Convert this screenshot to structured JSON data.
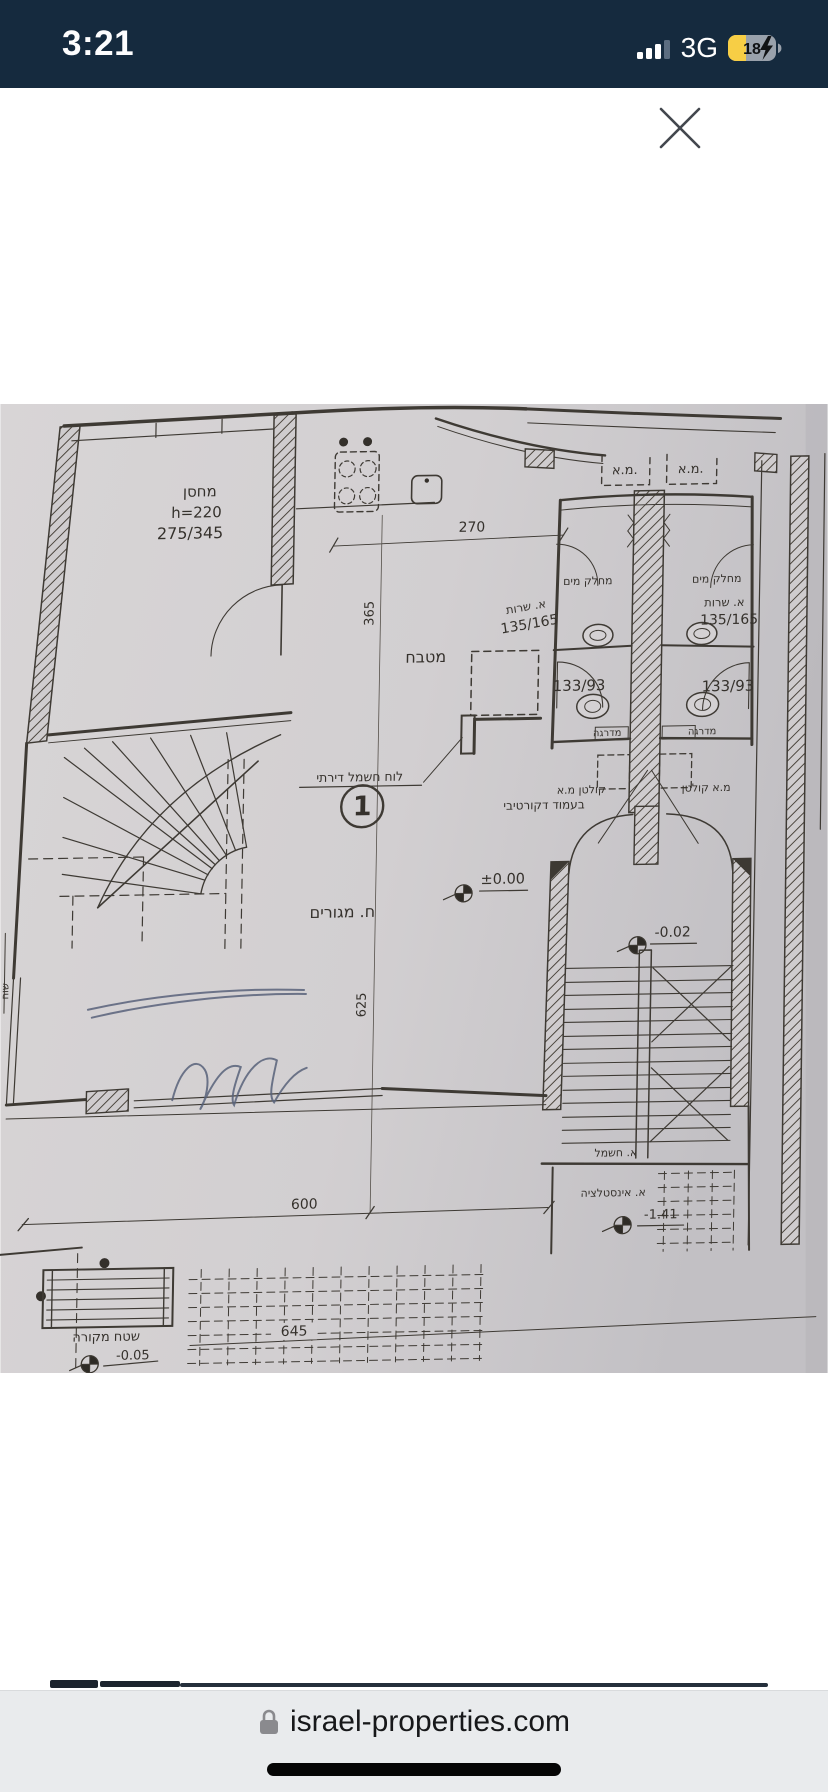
{
  "status_bar": {
    "time": "3:21",
    "network": "3G",
    "battery_level": "18"
  },
  "icons": {
    "close": "x-icon",
    "cellular": "signal-bars-icon",
    "battery": "battery-charging-icon",
    "lock": "padlock-icon"
  },
  "floor_plan": {
    "labels": {
      "storage": "מחסן",
      "storage_height": "h=220",
      "storage_dims": "275/345",
      "kitchen": "מטבח",
      "dim_kitchen_width": "270",
      "dim_kitchen_depth": "365",
      "electrical_panel_note": "לוח חשמל דירתי",
      "plan_number": "1",
      "ac_unit_left": "מ.א.",
      "ac_unit_right": "מ.א.",
      "water_divider_left": "מחלק מים",
      "water_divider_right": "מחלק מים",
      "service_room_left": "א. שרות",
      "service_room_left_dims": "135/165",
      "service_room_right": "א. שרות",
      "service_room_right_dims": "135/165",
      "bathroom_left_dims": "133/93",
      "bathroom_right_dims": "133/93",
      "step_left": "מדרגה",
      "step_right": "מדרגה",
      "drain_left": "קולטן מ.א",
      "drain_right": "מ.א קולטן",
      "decorative_column_note": "בעמוד דקורטיבי",
      "living_room": "ח. מגורים",
      "dim_living_depth": "625",
      "level_main": "±0.00",
      "level_stairwell": "-0.02",
      "electrical_closet": "א. חשמל",
      "plumbing_closet": "א. אינסטלציה",
      "level_entry": "-1.41",
      "covered_area": "שטח מקורה",
      "level_covered": "-0.05",
      "dim_living_width": "600",
      "dim_terrace": "645",
      "side_note": "שוח"
    }
  },
  "browser_bar": {
    "domain": "israel-properties.com"
  }
}
